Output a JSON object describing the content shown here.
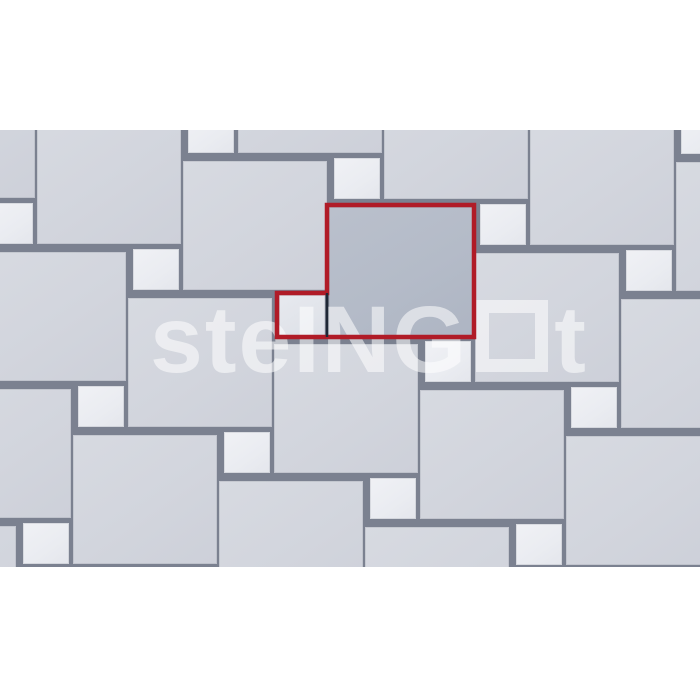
{
  "canvas": {
    "width": 700,
    "height": 700,
    "background": "#ffffff"
  },
  "pattern": {
    "top": 130,
    "height": 437,
    "joint_color": "#7b8190",
    "large": {
      "w": 147,
      "h": 132,
      "color": "#d3d6de"
    },
    "small": {
      "w": 49,
      "h": 44,
      "color": "#ecedf2"
    },
    "large_tiles": [
      [
        236,
        22
      ],
      [
        382,
        68
      ],
      [
        528,
        114
      ],
      [
        674,
        160
      ],
      [
        -111,
        67
      ],
      [
        35,
        113
      ],
      [
        181,
        159
      ],
      [
        473,
        251
      ],
      [
        619,
        297
      ],
      [
        -20,
        250
      ],
      [
        126,
        296
      ],
      [
        272,
        342
      ],
      [
        418,
        388
      ],
      [
        564,
        434
      ],
      [
        -75,
        387
      ],
      [
        71,
        433
      ],
      [
        217,
        479
      ],
      [
        363,
        525
      ],
      [
        -130,
        524
      ]
    ],
    "small_tiles": [
      [
        679,
        111
      ],
      [
        186,
        110
      ],
      [
        332,
        156
      ],
      [
        478,
        202
      ],
      [
        624,
        248
      ],
      [
        -15,
        201
      ],
      [
        131,
        247
      ],
      [
        423,
        339
      ],
      [
        569,
        385
      ],
      [
        76,
        384
      ],
      [
        222,
        430
      ],
      [
        368,
        476
      ],
      [
        514,
        522
      ],
      [
        21,
        521
      ]
    ]
  },
  "highlight": {
    "large": {
      "x": 327,
      "y": 205,
      "w": 147,
      "h": 132,
      "color": "#b4bbc8"
    },
    "small": {
      "x": 277,
      "y": 293,
      "w": 49,
      "h": 44,
      "color": "#e1e4ea"
    },
    "outline_color": "#b01b27",
    "outline_width": 4.5,
    "divider_color": "#1e2735",
    "divider_width": 2.5
  },
  "watermark": {
    "text_before": "ste",
    "text_caps": "ING",
    "text_after": "t",
    "color": "rgba(255,255,255,0.55)",
    "left": 150,
    "top": 163
  }
}
